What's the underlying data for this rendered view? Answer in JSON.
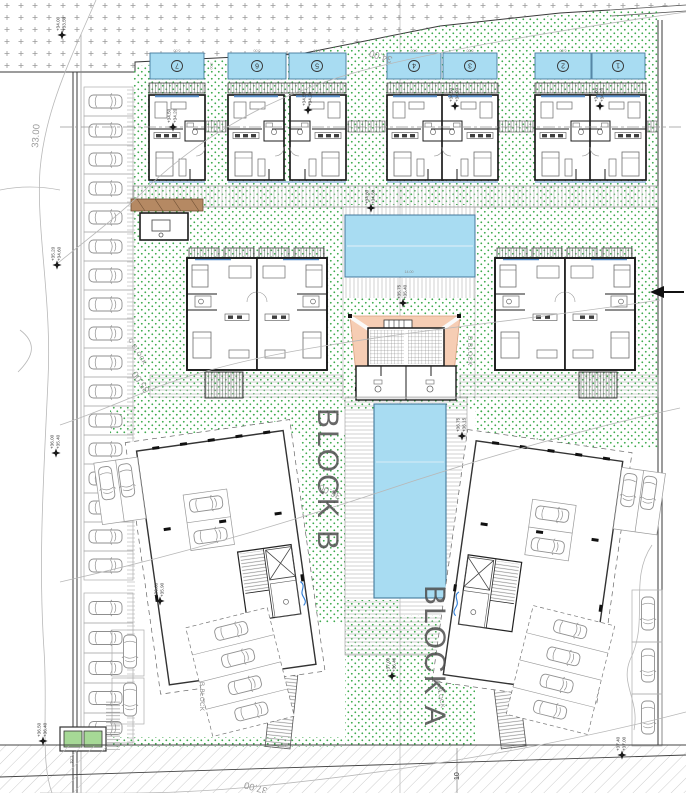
{
  "drawing": {
    "contours": {
      "c33": "33.00",
      "c34": "34.00",
      "c35": "35.00",
      "c36": "36.00",
      "c37": "37.00"
    },
    "blocks": {
      "block_a": "BLOCK A",
      "block_b": "BLOCK B",
      "c_block": "C BLOCK",
      "d_block": "D BLOCK",
      "a_block_small": "A BLOCK",
      "b_block_small": "B BLOCK"
    },
    "pool_numbers": [
      "7",
      "6",
      "5",
      "4",
      "3",
      "2",
      "1"
    ],
    "dims": {
      "pool_w": "6.00",
      "pool_h": "3.00",
      "main_pool": "14.00",
      "road": "10"
    },
    "utility_label": "L.01",
    "colors": {
      "pool": "#a8dcf2",
      "green_dot": "#3aa94a",
      "sail": "#f6cdb4",
      "window_blue": "#5b8fc9",
      "section_blue": "#2b7bd6"
    },
    "elevations": [
      {
        "top": "+34.00",
        "bottom": "+33.50"
      },
      {
        "top": "+34.50",
        "bottom": "+34.20"
      },
      {
        "top": "+34.50",
        "bottom": "+34.20"
      },
      {
        "top": "+34.50",
        "bottom": "+34.20"
      },
      {
        "top": "+34.50",
        "bottom": "+34.20"
      },
      {
        "top": "+35.20",
        "bottom": "+34.60"
      },
      {
        "top": "+36.00",
        "bottom": "+35.40"
      },
      {
        "top": "+34.80",
        "bottom": "+34.50"
      },
      {
        "top": "+35.75",
        "bottom": "+35.40"
      },
      {
        "top": "+36.75",
        "bottom": "+36.15"
      },
      {
        "top": "+36.60",
        "bottom": "+35.90"
      },
      {
        "top": "+37.00",
        "bottom": "+36.40"
      },
      {
        "top": "+36.50",
        "bottom": "+36.40"
      },
      {
        "top": "+37.40",
        "bottom": "+37.00"
      }
    ]
  }
}
